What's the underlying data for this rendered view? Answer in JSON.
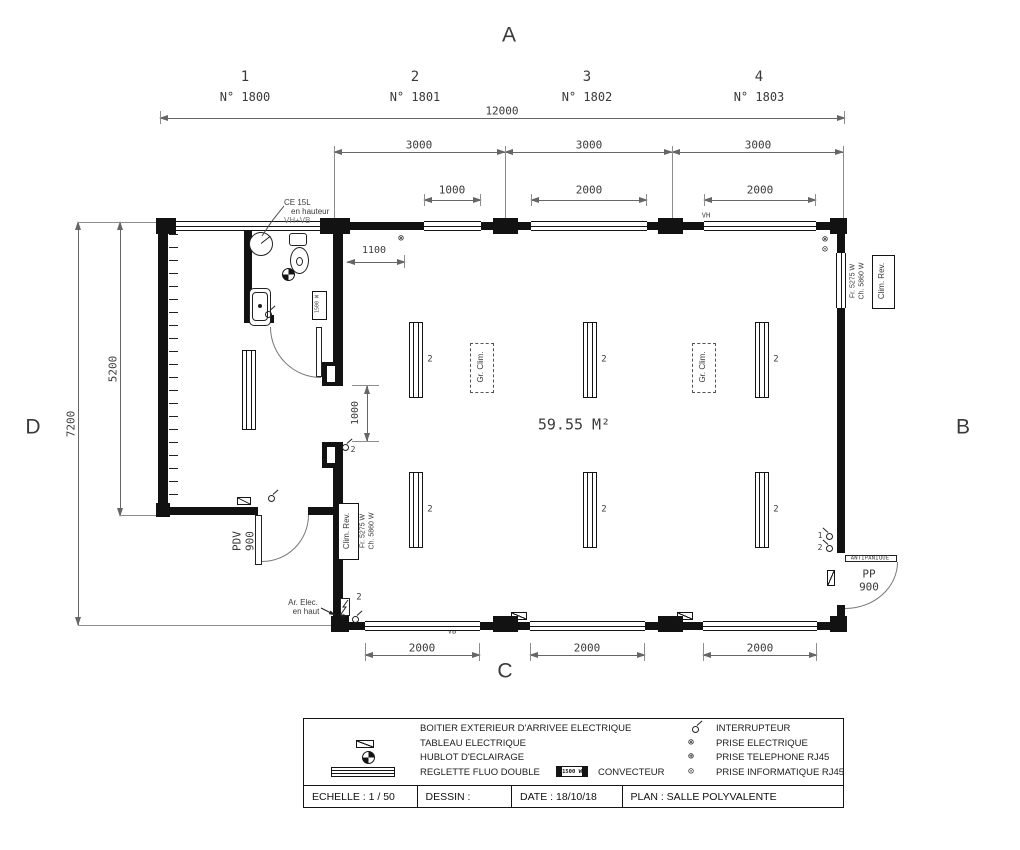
{
  "grid": {
    "top": "A",
    "right": "B",
    "bottom": "C",
    "left": "D",
    "columns": [
      {
        "num": "1",
        "ref": "N° 1800"
      },
      {
        "num": "2",
        "ref": "N° 1801"
      },
      {
        "num": "3",
        "ref": "N° 1802"
      },
      {
        "num": "4",
        "ref": "N° 1803"
      }
    ]
  },
  "dims": {
    "total": "12000",
    "bay1": "3000",
    "bay2": "3000",
    "bay3": "3000",
    "win_top1": "1000",
    "win_top2": "2000",
    "win_top3": "2000",
    "win_bot1": "2000",
    "win_bot2": "2000",
    "win_bot3": "2000",
    "left_outer": "7200",
    "left_inner": "5200",
    "socket_offset": "1100",
    "door_opening": "1000"
  },
  "room": {
    "area": "59.55 M²"
  },
  "labels": {
    "ce": "CE 15L",
    "ce2": "en hauteur",
    "ce3": "VH+VB",
    "vh": "VH",
    "vb": "VB",
    "clim_name": "Clim. Rev.",
    "clim_fr": "Fr. 5275 W",
    "clim_ch": "Ch. 5860 W",
    "gr_clim": "Gr. Clim.",
    "conv": "1500 W",
    "pdv1": "PDV",
    "pdv2": "900",
    "antipanique": "ANTIPANIQUE",
    "pp1": "PP",
    "pp2": "900",
    "ar1": "Ar. Elec.",
    "ar2": "en haut",
    "n1": "1",
    "n2": "2"
  },
  "icons": {
    "outlet": "⊗",
    "phone": "⊕",
    "data": "⊙"
  },
  "legend": {
    "left": [
      "BOITIER EXTERIEUR D'ARRIVEE ELECTRIQUE",
      "TABLEAU ELECTRIQUE",
      "HUBLOT D'ECLAIRAGE",
      "REGLETTE FLUO DOUBLE"
    ],
    "conv_box": "1500 W",
    "conv_label": "CONVECTEUR",
    "right": [
      "INTERRUPTEUR",
      "PRISE ELECTRIQUE",
      "PRISE TELEPHONE RJ45",
      "PRISE INFORMATIQUE RJ45"
    ]
  },
  "titleblock": {
    "echelle": "ECHELLE : 1 / 50",
    "dessin": "DESSIN :",
    "date": "DATE : 18/10/18",
    "plan": "PLAN : SALLE POLYVALENTE"
  }
}
